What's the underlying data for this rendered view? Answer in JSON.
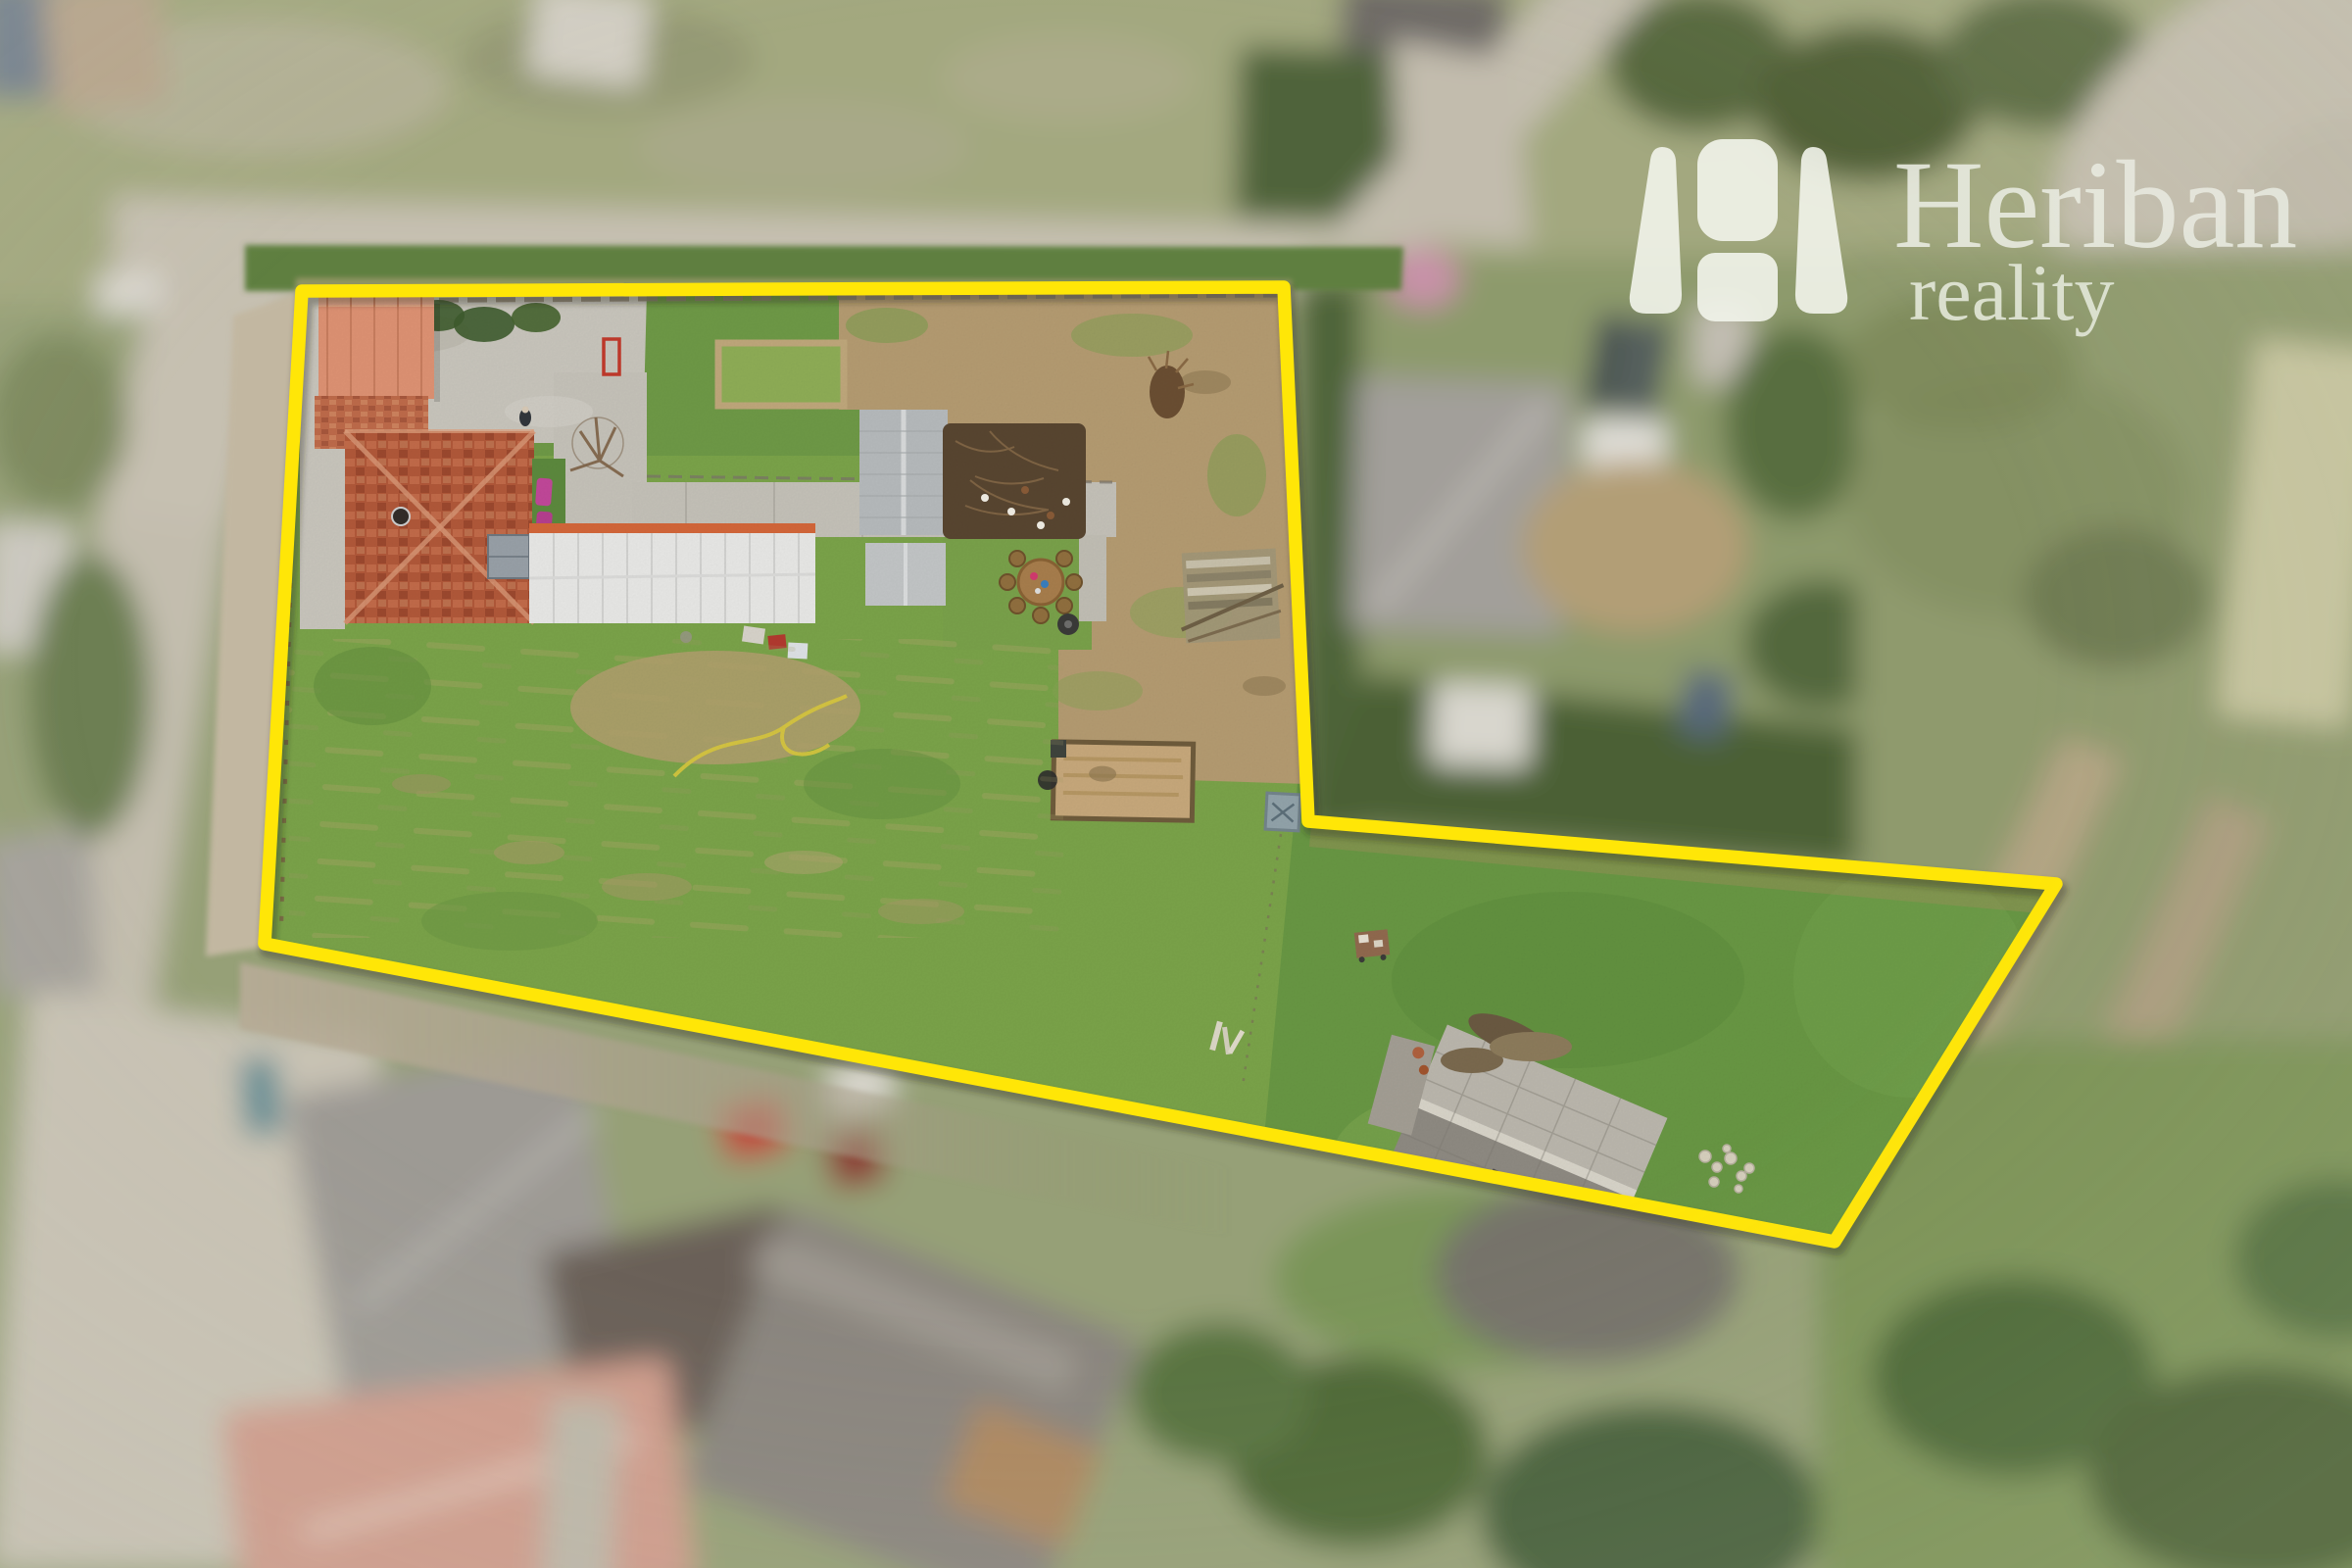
{
  "logo": {
    "brand": "Heriban",
    "sub": "reality",
    "color": "#edf0e4"
  },
  "overlay": {
    "boundary_color": "#ffe607",
    "boundary_points": "308,297 1310,293 1335,838 2098,902 1872,1267 270,963",
    "boundary_stroke_width": "13.5"
  },
  "scene": {
    "type": "aerial-drone-photo",
    "focus_area": "outlined land plot with farmhouse, outbuildings and long garden",
    "objects_in_plot": [
      "salmon-roof garage",
      "terracotta hip-roof house",
      "white long outbuilding",
      "grey corrugated shed",
      "compost brush pen with chickens",
      "round wooden table with stump seats",
      "straw garden bed",
      "large lawn",
      "ruined grey-roof building",
      "stone pile",
      "garden hose"
    ],
    "surroundings": [
      "village roads",
      "neighbour houses with grey and salmon roofs",
      "red car",
      "grey hip-roof house with white garage and solar panels",
      "fields and trees"
    ]
  }
}
